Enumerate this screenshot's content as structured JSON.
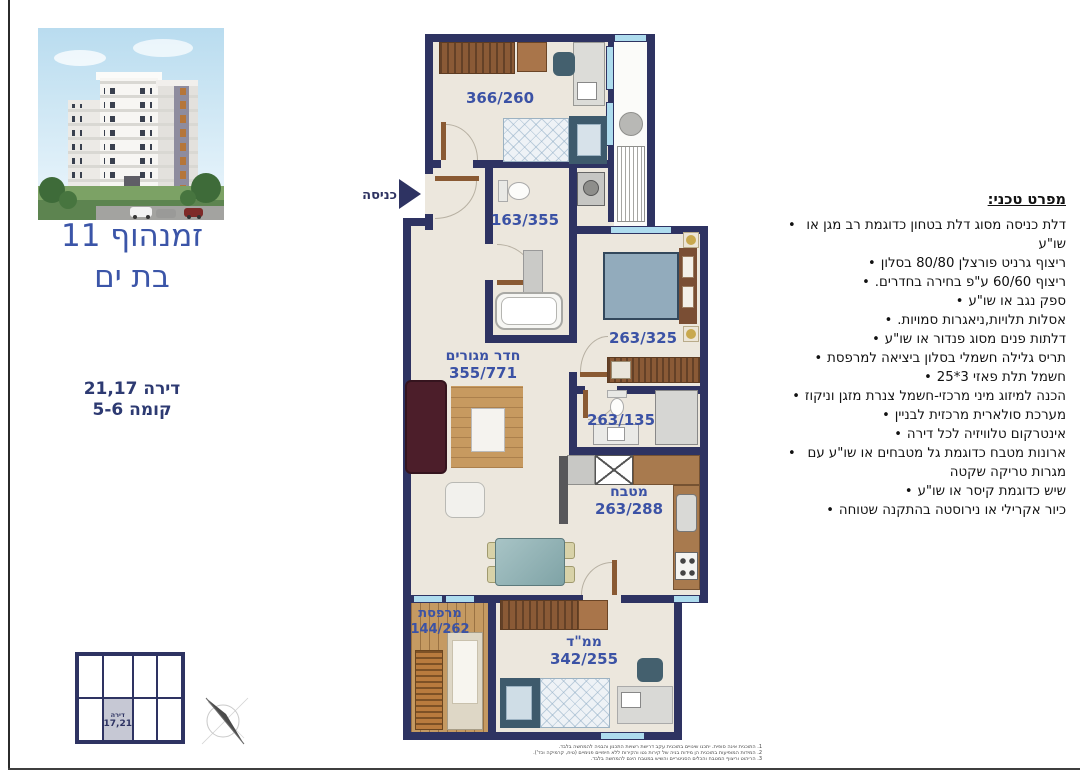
{
  "page": {
    "project_title_line1": "זמנהוף 11",
    "project_title_line2": "בת ים",
    "apartment_line1": "דירה 21,17",
    "apartment_line2": "קומה 5-6"
  },
  "plan": {
    "entrance_label": "כניסה",
    "rooms": [
      {
        "name": "",
        "dims": "366/260"
      },
      {
        "name": "",
        "dims": "163/355"
      },
      {
        "name": "",
        "dims": "263/325"
      },
      {
        "name": "חדר מגורים",
        "dims": "355/771"
      },
      {
        "name": "",
        "dims": "263/135"
      },
      {
        "name": "מטבח",
        "dims": "263/288"
      },
      {
        "name": "מרפסת",
        "dims": "144/262"
      },
      {
        "name": "ממ\"ד",
        "dims": "342/255"
      }
    ]
  },
  "specs": {
    "title": "מפרט טכני:",
    "items": [
      "דלת כניסה מסוג דלת בטחון כדוגמת רב מגן או שו\"ע",
      "ריצוף גרניט פורצלן 80/80 בסלון",
      "ריצוף 60/60 ע\"פ בחירה בחדרים.",
      "ספק נגב או שו\"ע",
      "אסלות תלויות,ניאגרות סמויות.",
      "דלתות פנים מסוג פנדור או שו\"ע",
      "תריס גלילה חשמלי בסלון ביציאה למרפסת",
      "חשמל תלת פאזי 3*25",
      "הכנה למיזוג מיני מרכזי-חשמל צנרת מזגן וניקוז",
      "מערכת סולארית מרכזית לבניין",
      "אינטרקום טלוויזיה לכל דירה",
      "ארונות מטבח כדוגמת גל מטבחים או שו\"ע עם מגרות טריקה שקטה",
      "שיש כדוגמת קיסר או שו\"ע",
      "כיור אקרילי או נירוסטה בהתקנה שטוחה"
    ]
  },
  "unit_locator": {
    "highlight_line1": "דירה",
    "highlight_line2": "17,21"
  },
  "footnotes": [
    "1. התוכנית אינה סופית. יתכנו שינויים בתוכנית עקב דרישת רשויות התכנון והבניה להמחשה בלבד.",
    "2. המידות המופיעות בתוכנית הן מידות בניה של קירות נטו והקירות ללא חיפויים פנימיים (טיח, קרמיקה וכד').",
    "3. הריהוט וריצוף המטבח והכלים הסניטריים והשיש במטבח הינם להמחשה בלבד."
  ],
  "colors": {
    "wall_navy": "#2e3362",
    "floor_cream": "#ece7dd",
    "label_blue": "#3b52a5",
    "title_blue": "#3b55a8",
    "window_blue": "#aedcee",
    "locator_highlight": "#c6c8d4"
  }
}
